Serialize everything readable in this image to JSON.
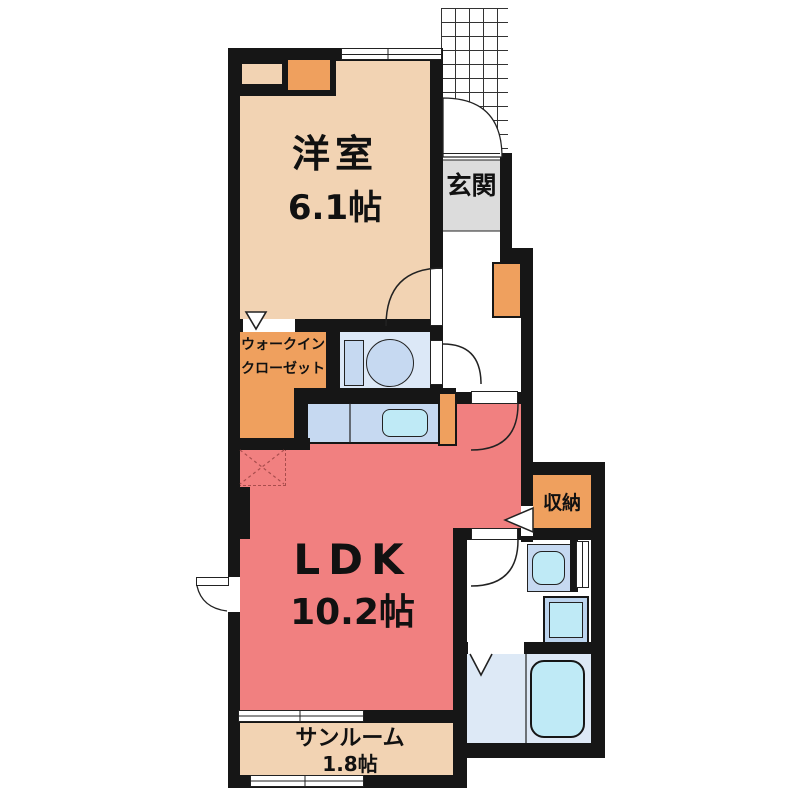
{
  "colors": {
    "wall": "#161616",
    "room_beige": "#f2d3b3",
    "closet_orange": "#efa05e",
    "ldk_pink": "#f18080",
    "entrance_gray": "#dcdcdc",
    "floor_blue": "#dce8f7",
    "fixture_blue": "#c6d9f1",
    "water_cyan": "#bfeaf6"
  },
  "rooms": {
    "western_room": {
      "name": "洋室",
      "size": "6.1帖"
    },
    "entrance": {
      "name": "玄関"
    },
    "walk_in_closet": {
      "line1": "ウォークイン",
      "line2": "クローゼット"
    },
    "ldk": {
      "name": "LDK",
      "size": "10.2帖"
    },
    "storage": {
      "name": "収納"
    },
    "sunroom": {
      "name": "サンルーム",
      "size": "1.8帖"
    }
  }
}
